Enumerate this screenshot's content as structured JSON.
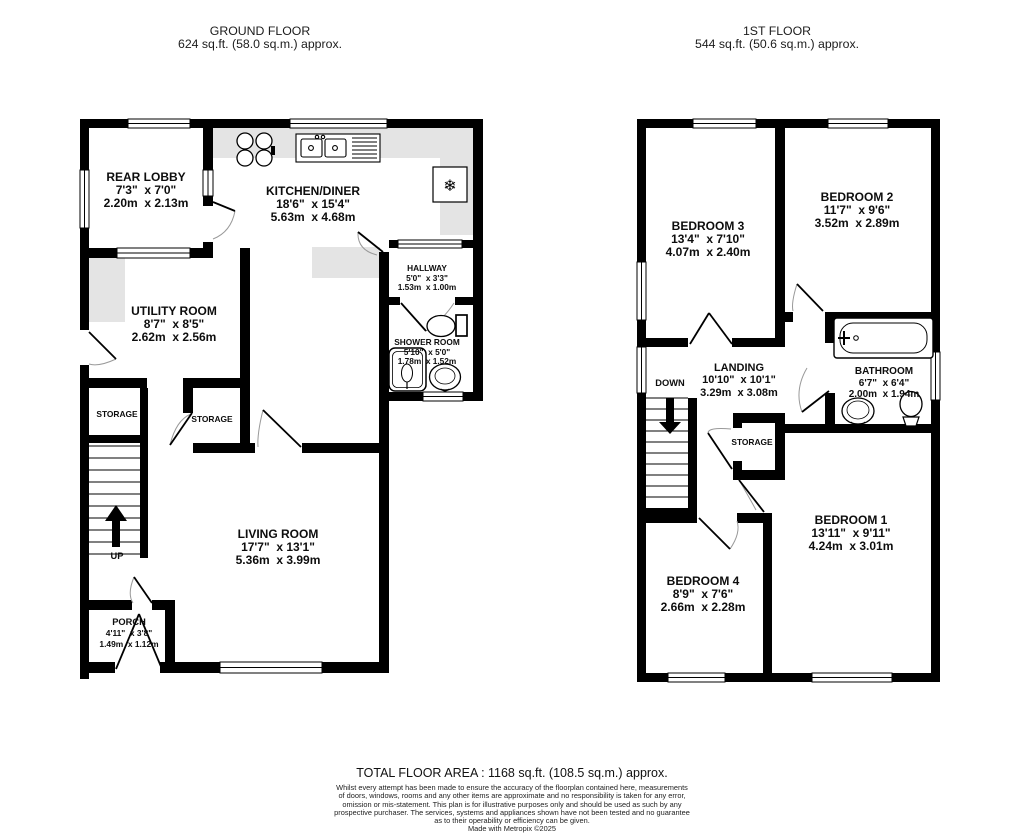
{
  "ground_floor": {
    "title": "GROUND FLOOR",
    "area": "624 sq.ft. (58.0 sq.m.) approx.",
    "rooms": {
      "rear_lobby": {
        "name": "REAR LOBBY",
        "imperial": "7'3\"  x 7'0\"",
        "metric": "2.20m  x 2.13m"
      },
      "kitchen_diner": {
        "name": "KITCHEN/DINER",
        "imperial": "18'6\"  x 15'4\"",
        "metric": "5.63m  x 4.68m"
      },
      "utility_room": {
        "name": "UTILITY ROOM",
        "imperial": "8'7\"  x 8'5\"",
        "metric": "2.62m  x 2.56m"
      },
      "hallway": {
        "name": "HALLWAY",
        "imperial": "5'0\"  x 3'3\"",
        "metric": "1.53m  x 1.00m"
      },
      "shower_room": {
        "name": "SHOWER ROOM",
        "imperial": "5'10\"  x 5'0\"",
        "metric": "1.78m  x 1.52m"
      },
      "living_room": {
        "name": "LIVING ROOM",
        "imperial": "17'7\"  x 13'1\"",
        "metric": "5.36m  x 3.99m"
      },
      "porch": {
        "name": "PORCH",
        "imperial": "4'11\"  x 3'8\"",
        "metric": "1.49m  x 1.12m"
      }
    },
    "labels": {
      "up": "UP",
      "storage_left": "STORAGE",
      "storage_right": "STORAGE"
    }
  },
  "first_floor": {
    "title": "1ST FLOOR",
    "area": "544 sq.ft. (50.6 sq.m.) approx.",
    "rooms": {
      "bedroom_1": {
        "name": "BEDROOM 1",
        "imperial": "13'11\"  x 9'11\"",
        "metric": "4.24m  x 3.01m"
      },
      "bedroom_2": {
        "name": "BEDROOM 2",
        "imperial": "11'7\"  x 9'6\"",
        "metric": "3.52m  x 2.89m"
      },
      "bedroom_3": {
        "name": "BEDROOM 3",
        "imperial": "13'4\"  x 7'10\"",
        "metric": "4.07m  x 2.40m"
      },
      "bedroom_4": {
        "name": "BEDROOM 4",
        "imperial": "8'9\"  x 7'6\"",
        "metric": "2.66m  x 2.28m"
      },
      "landing": {
        "name": "LANDING",
        "imperial": "10'10\"  x 10'1\"",
        "metric": "3.29m  x 3.08m"
      },
      "bathroom": {
        "name": "BATHROOM",
        "imperial": "6'7\"  x 6'4\"",
        "metric": "2.00m  x 1.94m"
      }
    },
    "labels": {
      "down": "DOWN",
      "storage": "STORAGE"
    }
  },
  "icons": {
    "freezer": "❄"
  },
  "footer": {
    "total_area": "TOTAL FLOOR AREA : 1168 sq.ft. (108.5 sq.m.) approx.",
    "disclaimer_lines": [
      "Whilst every attempt has been made to ensure the accuracy of the floorplan contained here, measurements",
      "of doors, windows, rooms and any other items are approximate and no responsibility is taken for any error,",
      "omission or mis-statement. This plan is for illustrative purposes only and should be used as such by any",
      "prospective purchaser. The services, systems and appliances shown have not been tested and no guarantee",
      "as to their operability or efficiency can be given."
    ],
    "credit": "Made with Metropix ©2025"
  },
  "colors": {
    "wall": "#000000",
    "counter": "#e4e4e4",
    "door_arc": "#999999"
  }
}
